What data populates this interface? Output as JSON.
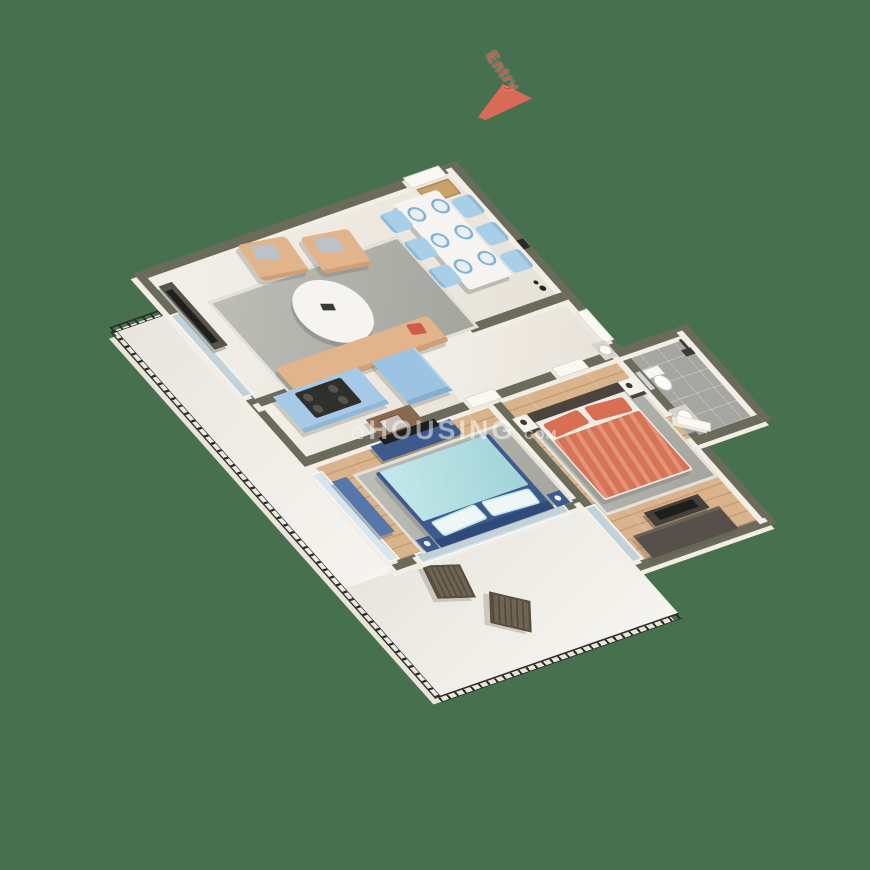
{
  "background": {
    "color": "#47714E"
  },
  "entry_marker": {
    "label": "Entry",
    "label_color": "#C8584A",
    "arrow_color": "#D96A57"
  },
  "watermark": {
    "house_icon": "⌂",
    "text": "HOUSING",
    "suffix": ".COM",
    "color": "rgba(255,255,255,0.5)"
  },
  "palette": {
    "wall_cap": "#6B6B5C",
    "wall_face": "#F4F1EA",
    "living_floor": "#ECE7DD",
    "wood_floor": "#D9B38B",
    "tile_floor": "#A6A6A1",
    "balcony_floor": "#F0EDE5",
    "railing": "#2B2B28",
    "kitchen_cabinet": "#A5C9E6",
    "fridge": "#9DC3E2",
    "dining_chair": "#A9CFE8",
    "table_marble": "#F6F4F0",
    "sofa": "#E2B48C",
    "pillow_gray": "#B9C3C9",
    "rug_gray": "#AFAFA8",
    "bed1_duvet": "#A6DCE0",
    "bed1_frame": "#3C5A8C",
    "bed2_duvet": "#E07A5C",
    "bed2_pillow": "#D96F52",
    "bed2_headboard": "#4A443C",
    "wardrobe": "#57504A",
    "tv_screen": "#1E1E1C",
    "console_olive": "#55554A",
    "counter_brown": "#8A6A4E",
    "balcony_chair": "#6F6352"
  }
}
